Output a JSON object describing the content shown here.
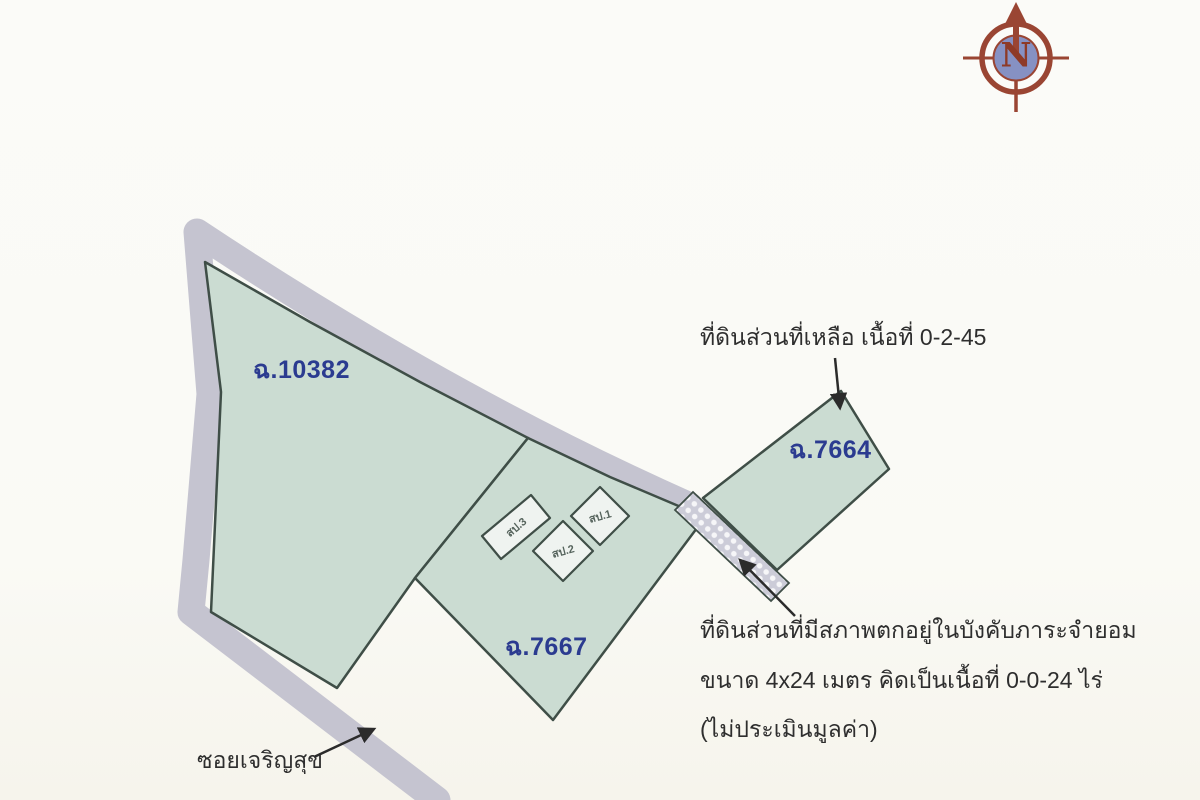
{
  "compass": {
    "letter": "N"
  },
  "parcels": {
    "p10382": {
      "label": "ฉ.10382"
    },
    "p7667": {
      "label": "ฉ.7667"
    },
    "p7664": {
      "label": "ฉ.7664"
    }
  },
  "buildings": {
    "b1": {
      "label": "สป.1"
    },
    "b2": {
      "label": "สป.2"
    },
    "b3": {
      "label": "สป.3"
    }
  },
  "annotations": {
    "remaining_land": "ที่ดินส่วนที่เหลือ เนื้อที่ 0-2-45",
    "servitude_line1": "ที่ดินส่วนที่มีสภาพตกอยู่ในบังคับภาระจำยอม",
    "servitude_line2": "ขนาด 4x24 เมตร คิดเป็นเนื้อที่ 0-0-24 ไร่",
    "servitude_line3": "(ไม่ประเมินมูลค่า)",
    "road": "ซอยเจริญสุข"
  },
  "colors": {
    "parcel_fill": "#cbdcd2",
    "parcel_stroke": "#3f4e47",
    "road_band": "#c5c4d0",
    "building_fill": "#eff3f0",
    "strip_base": "#ccccd8",
    "label_blue": "#2b3b90",
    "annotation_text": "#2e2e2e",
    "arrow_color": "#2b2b2b",
    "compass_red": "#9a4533",
    "compass_blue": "#8691c3"
  }
}
